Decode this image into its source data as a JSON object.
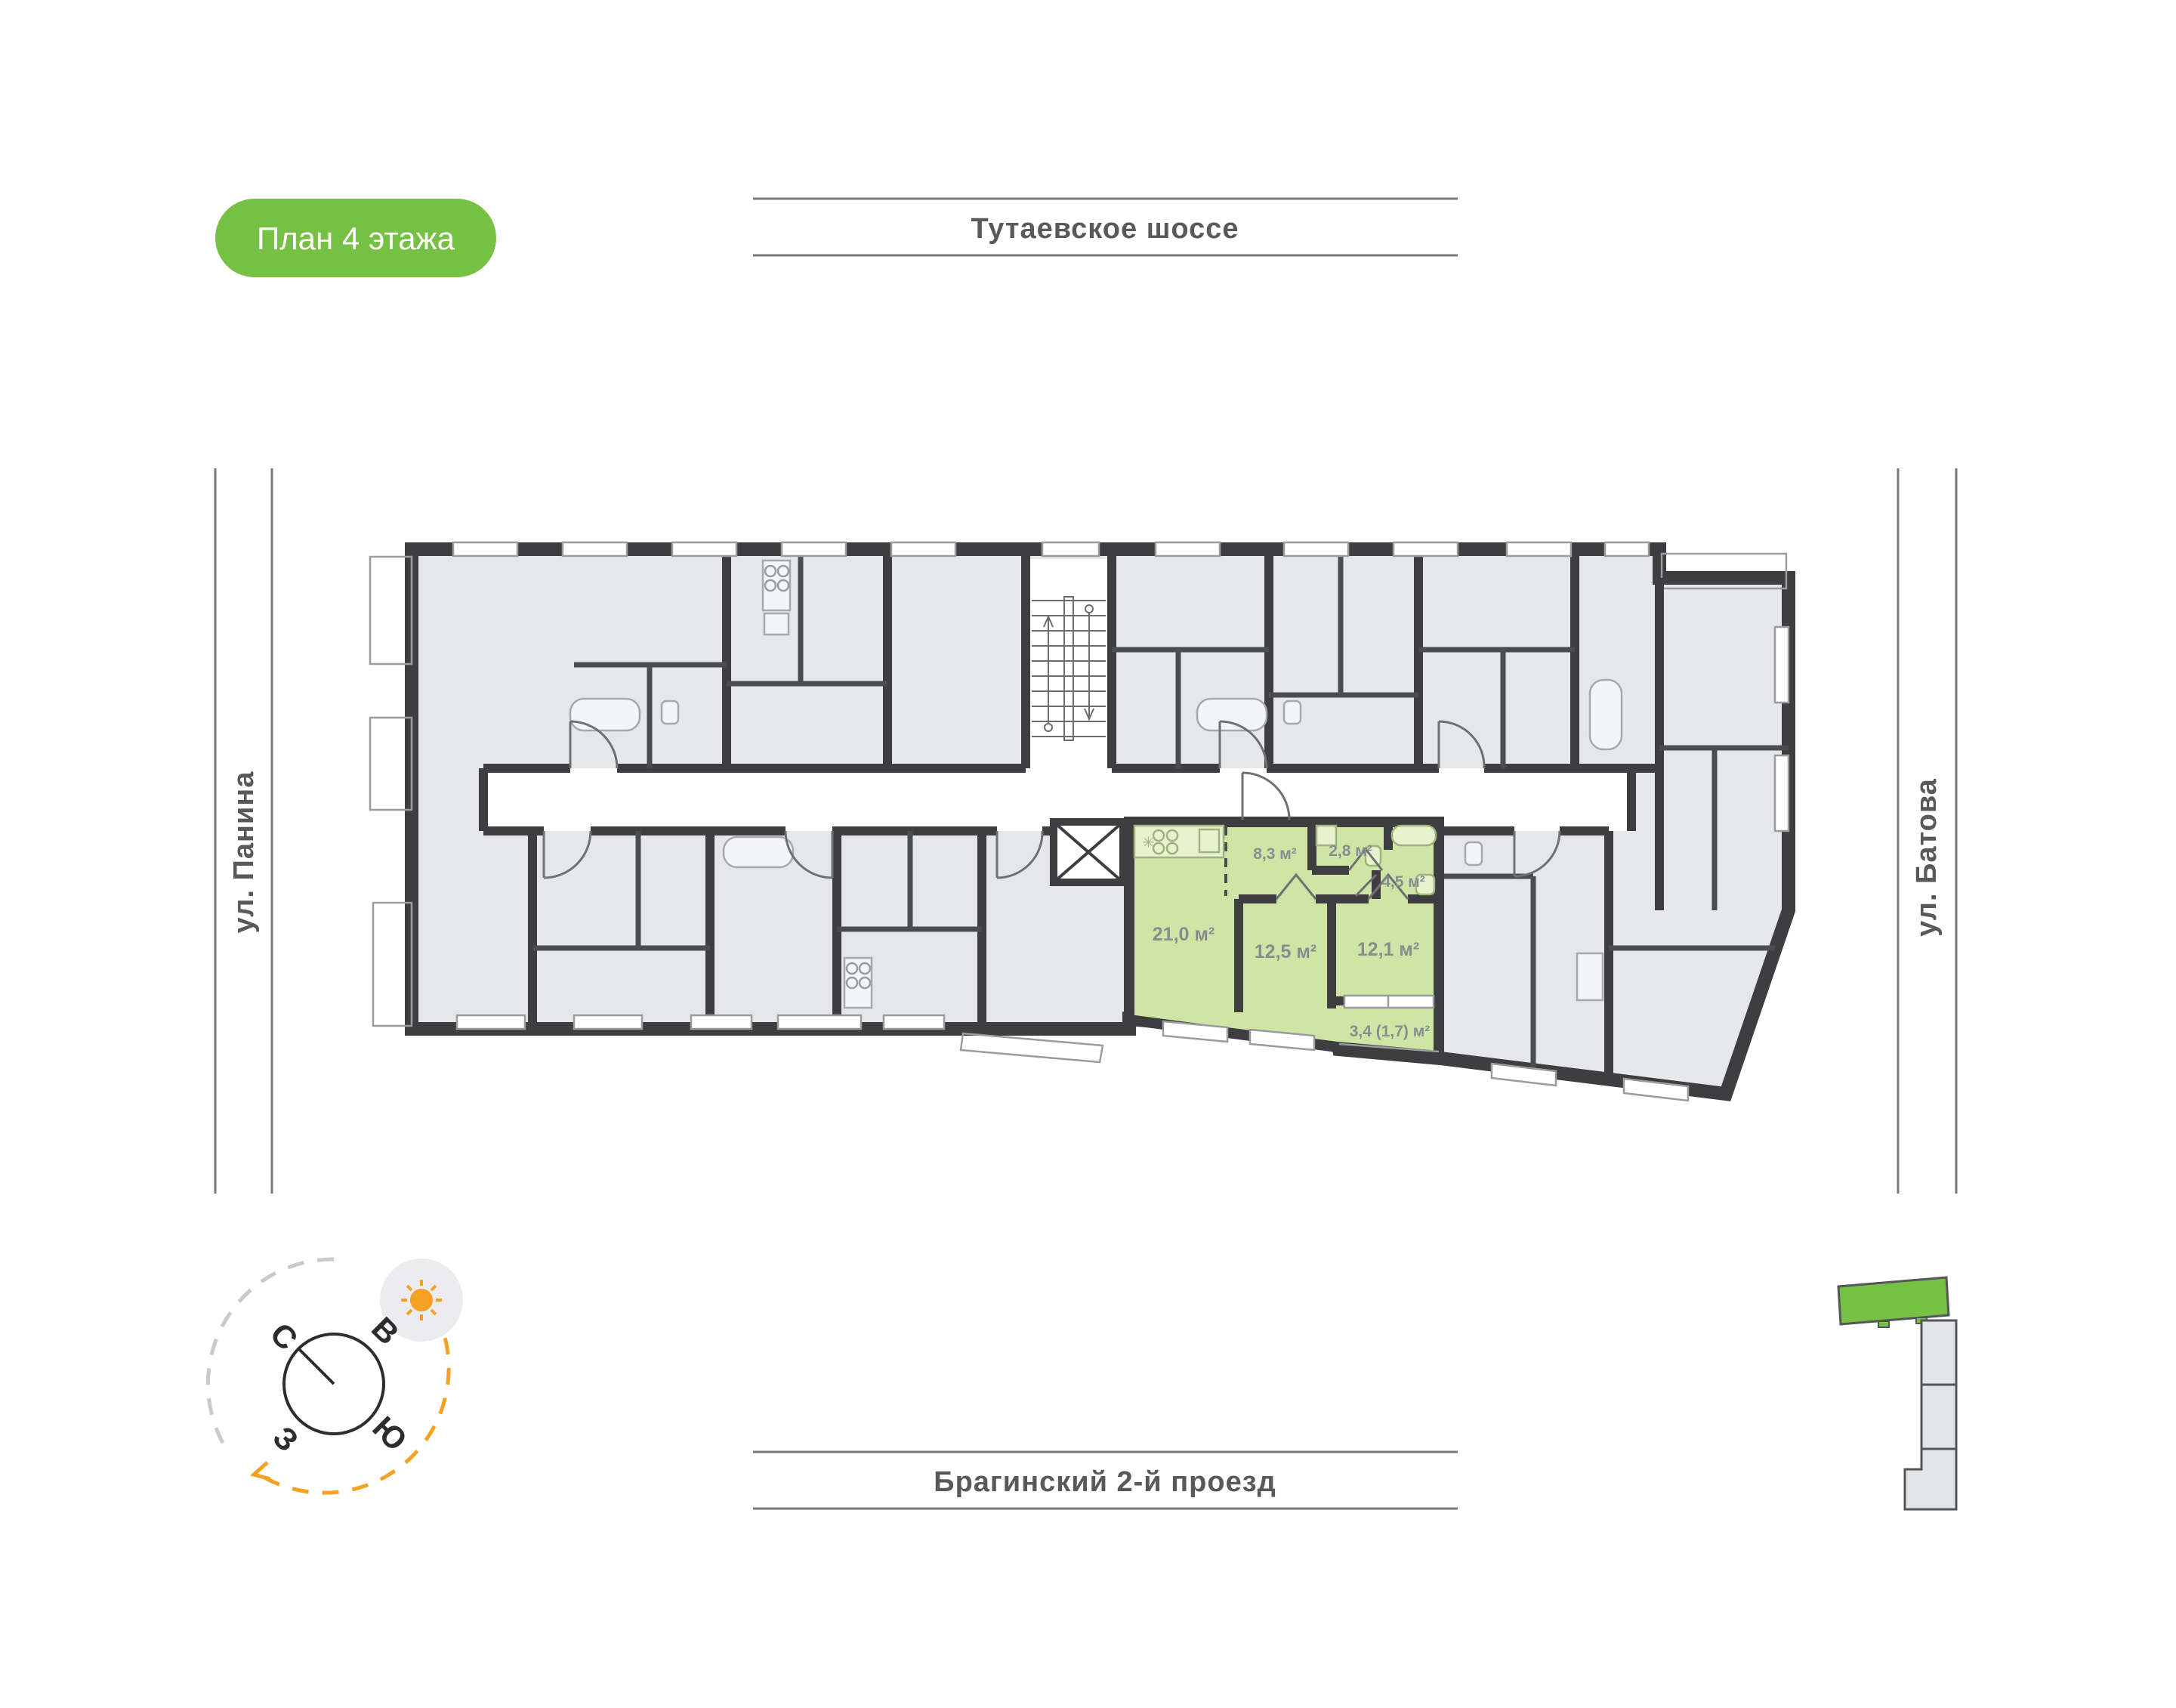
{
  "page": {
    "badge": "План 4 этажа"
  },
  "streets": {
    "top": "Тутаевское шоссе",
    "bottom": "Брагинский 2-й проезд",
    "left": "ул. Панина",
    "right": "ул. Батова"
  },
  "apartment": {
    "status": "highlighted",
    "rooms": [
      {
        "name": "kitchen-living",
        "area": "21,0 м²"
      },
      {
        "name": "hallway",
        "area": "8,3 м²"
      },
      {
        "name": "bathroom",
        "area": "2,8 м²"
      },
      {
        "name": "bathroom-2",
        "area": "4,5 м²"
      },
      {
        "name": "bedroom",
        "area": "12,5 м²"
      },
      {
        "name": "bedroom-2",
        "area": "12,1 м²"
      },
      {
        "name": "balcony",
        "area": "3,4 (1,7) м²"
      }
    ]
  },
  "compass": {
    "north": "С",
    "east": "В",
    "south": "Ю",
    "west": "З"
  },
  "colors": {
    "badge_green": "#76c043",
    "apartment_green": "#cfe5a5",
    "fixture_green": "#e7f2cf",
    "room_grey": "#e6e7e9",
    "wall_dark": "#3e3e40",
    "label_grey": "#8a8d8f",
    "street_text": "#58595b",
    "sun_orange": "#f5a125"
  }
}
